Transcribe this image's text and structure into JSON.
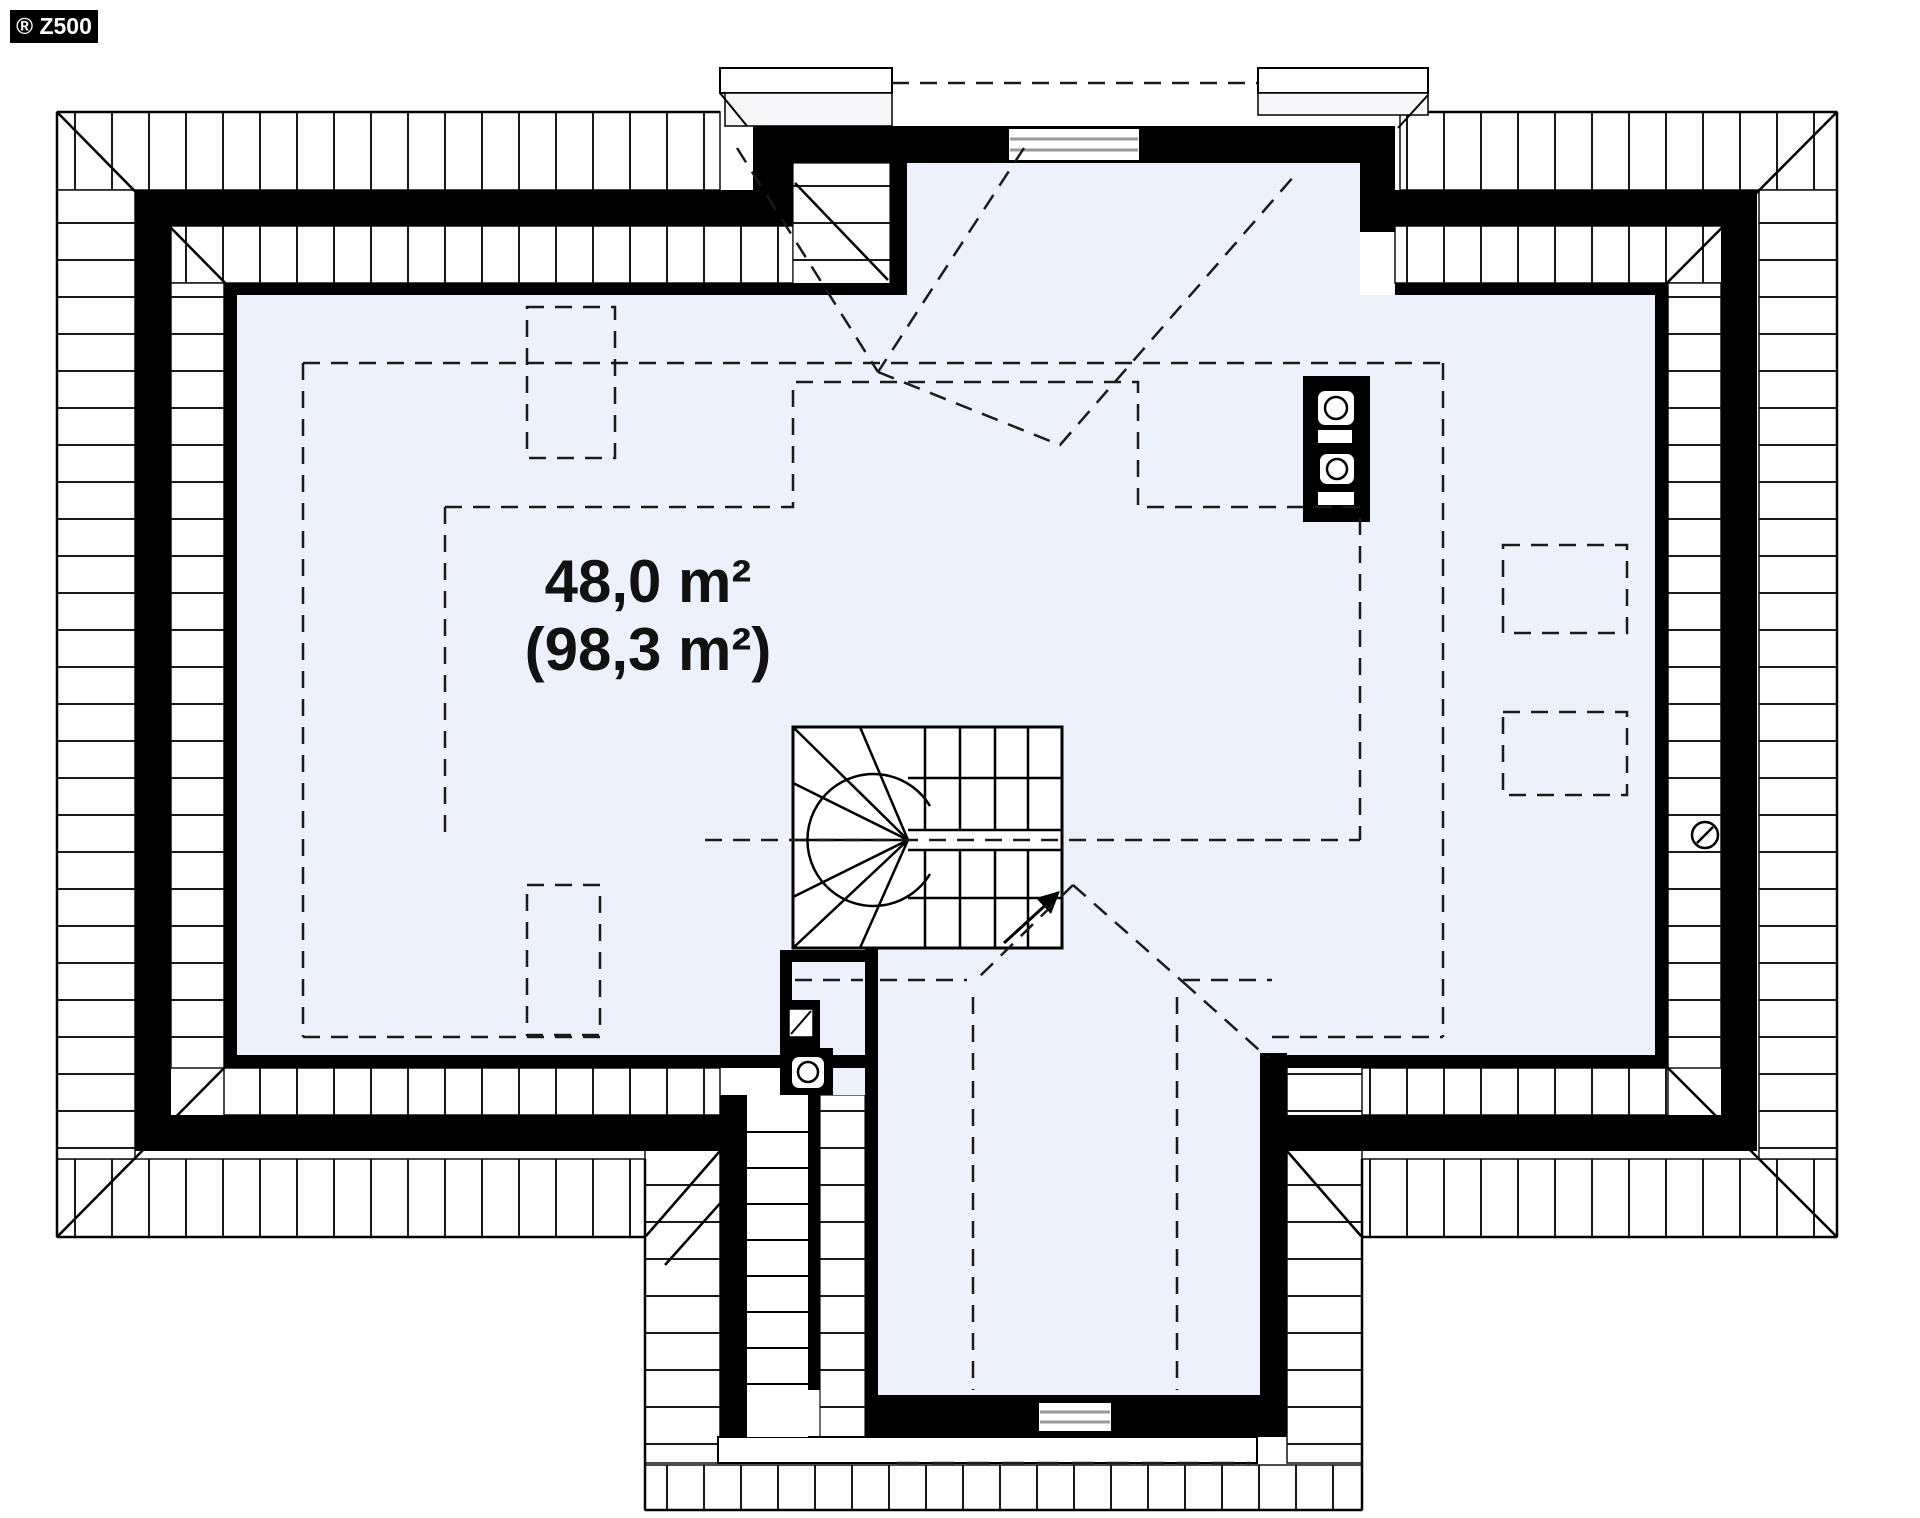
{
  "meta": {
    "logo_text": "® Z500",
    "drawing_type": "attic floor plan"
  },
  "plan": {
    "area_label": {
      "line1": "48,0 m²",
      "line2": "(98,3 m²)"
    },
    "colors": {
      "background": "#ffffff",
      "floor": "#edf1fb",
      "wall": "#000000",
      "hatch_line": "#1a1a1a",
      "hatch_bg": "#fdfdfe",
      "glazing": "#9a9a9a",
      "dash": "#1a1a1a"
    },
    "symbols": [
      {
        "name": "staircase",
        "desc": "U-shaped winder stair with up arrow"
      },
      {
        "name": "chimney-flues-main",
        "desc": "masonry chimney with two round flues and two vent slots"
      },
      {
        "name": "chimney-flue-secondary",
        "desc": "masonry chimney with one round flue and vent square"
      },
      {
        "name": "roof-window-dashed",
        "desc": "dashed roof window outlines"
      },
      {
        "name": "drain-vent-circle",
        "desc": "circle with slash on right roof slope"
      },
      {
        "name": "window-top-dormer",
        "desc": "glazed window in top dormer wall"
      },
      {
        "name": "window-bottom-wing",
        "desc": "glazed window in bottom wing wall"
      }
    ]
  }
}
